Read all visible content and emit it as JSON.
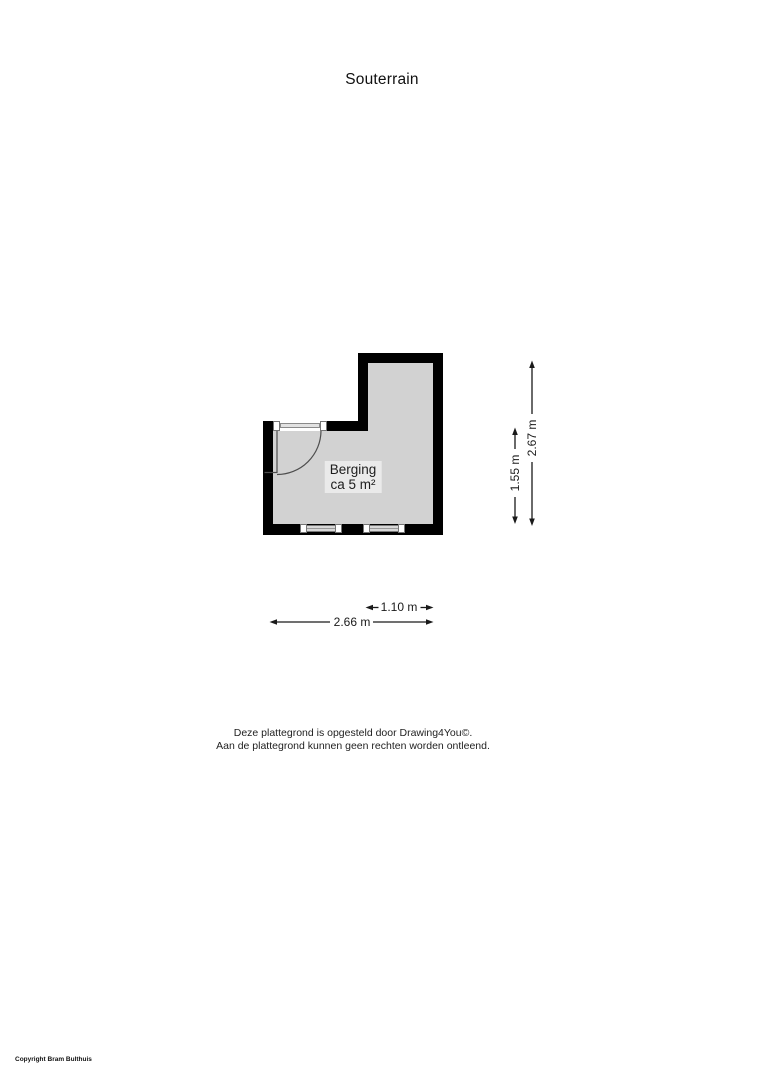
{
  "page": {
    "title": "Souterrain"
  },
  "floorplan": {
    "room": {
      "name": "Berging",
      "area": "ca 5 m²"
    },
    "dimensions": {
      "height_total": "2.67 m",
      "height_lower": "1.55 m",
      "width_upper": "1.10 m",
      "width_total": "2.66 m"
    },
    "features": {
      "door": "door-swing-top-left",
      "windows": "two-windows-bottom-wall"
    },
    "colors": {
      "wall": "#000000",
      "floor": "#d2d2d2",
      "room_label_bg": "#eaeaea",
      "dimension_line": "#1a1a1a",
      "window_frame": "#757575",
      "window_glass": "#d8d8d8",
      "door_swing": "#4d4d4d"
    }
  },
  "footer": {
    "line1": "Deze plattegrond is opgesteld door Drawing4You©.",
    "line2": "Aan de plattegrond kunnen geen rechten worden ontleend."
  },
  "copyright": "Copyright Bram Bulthuis"
}
